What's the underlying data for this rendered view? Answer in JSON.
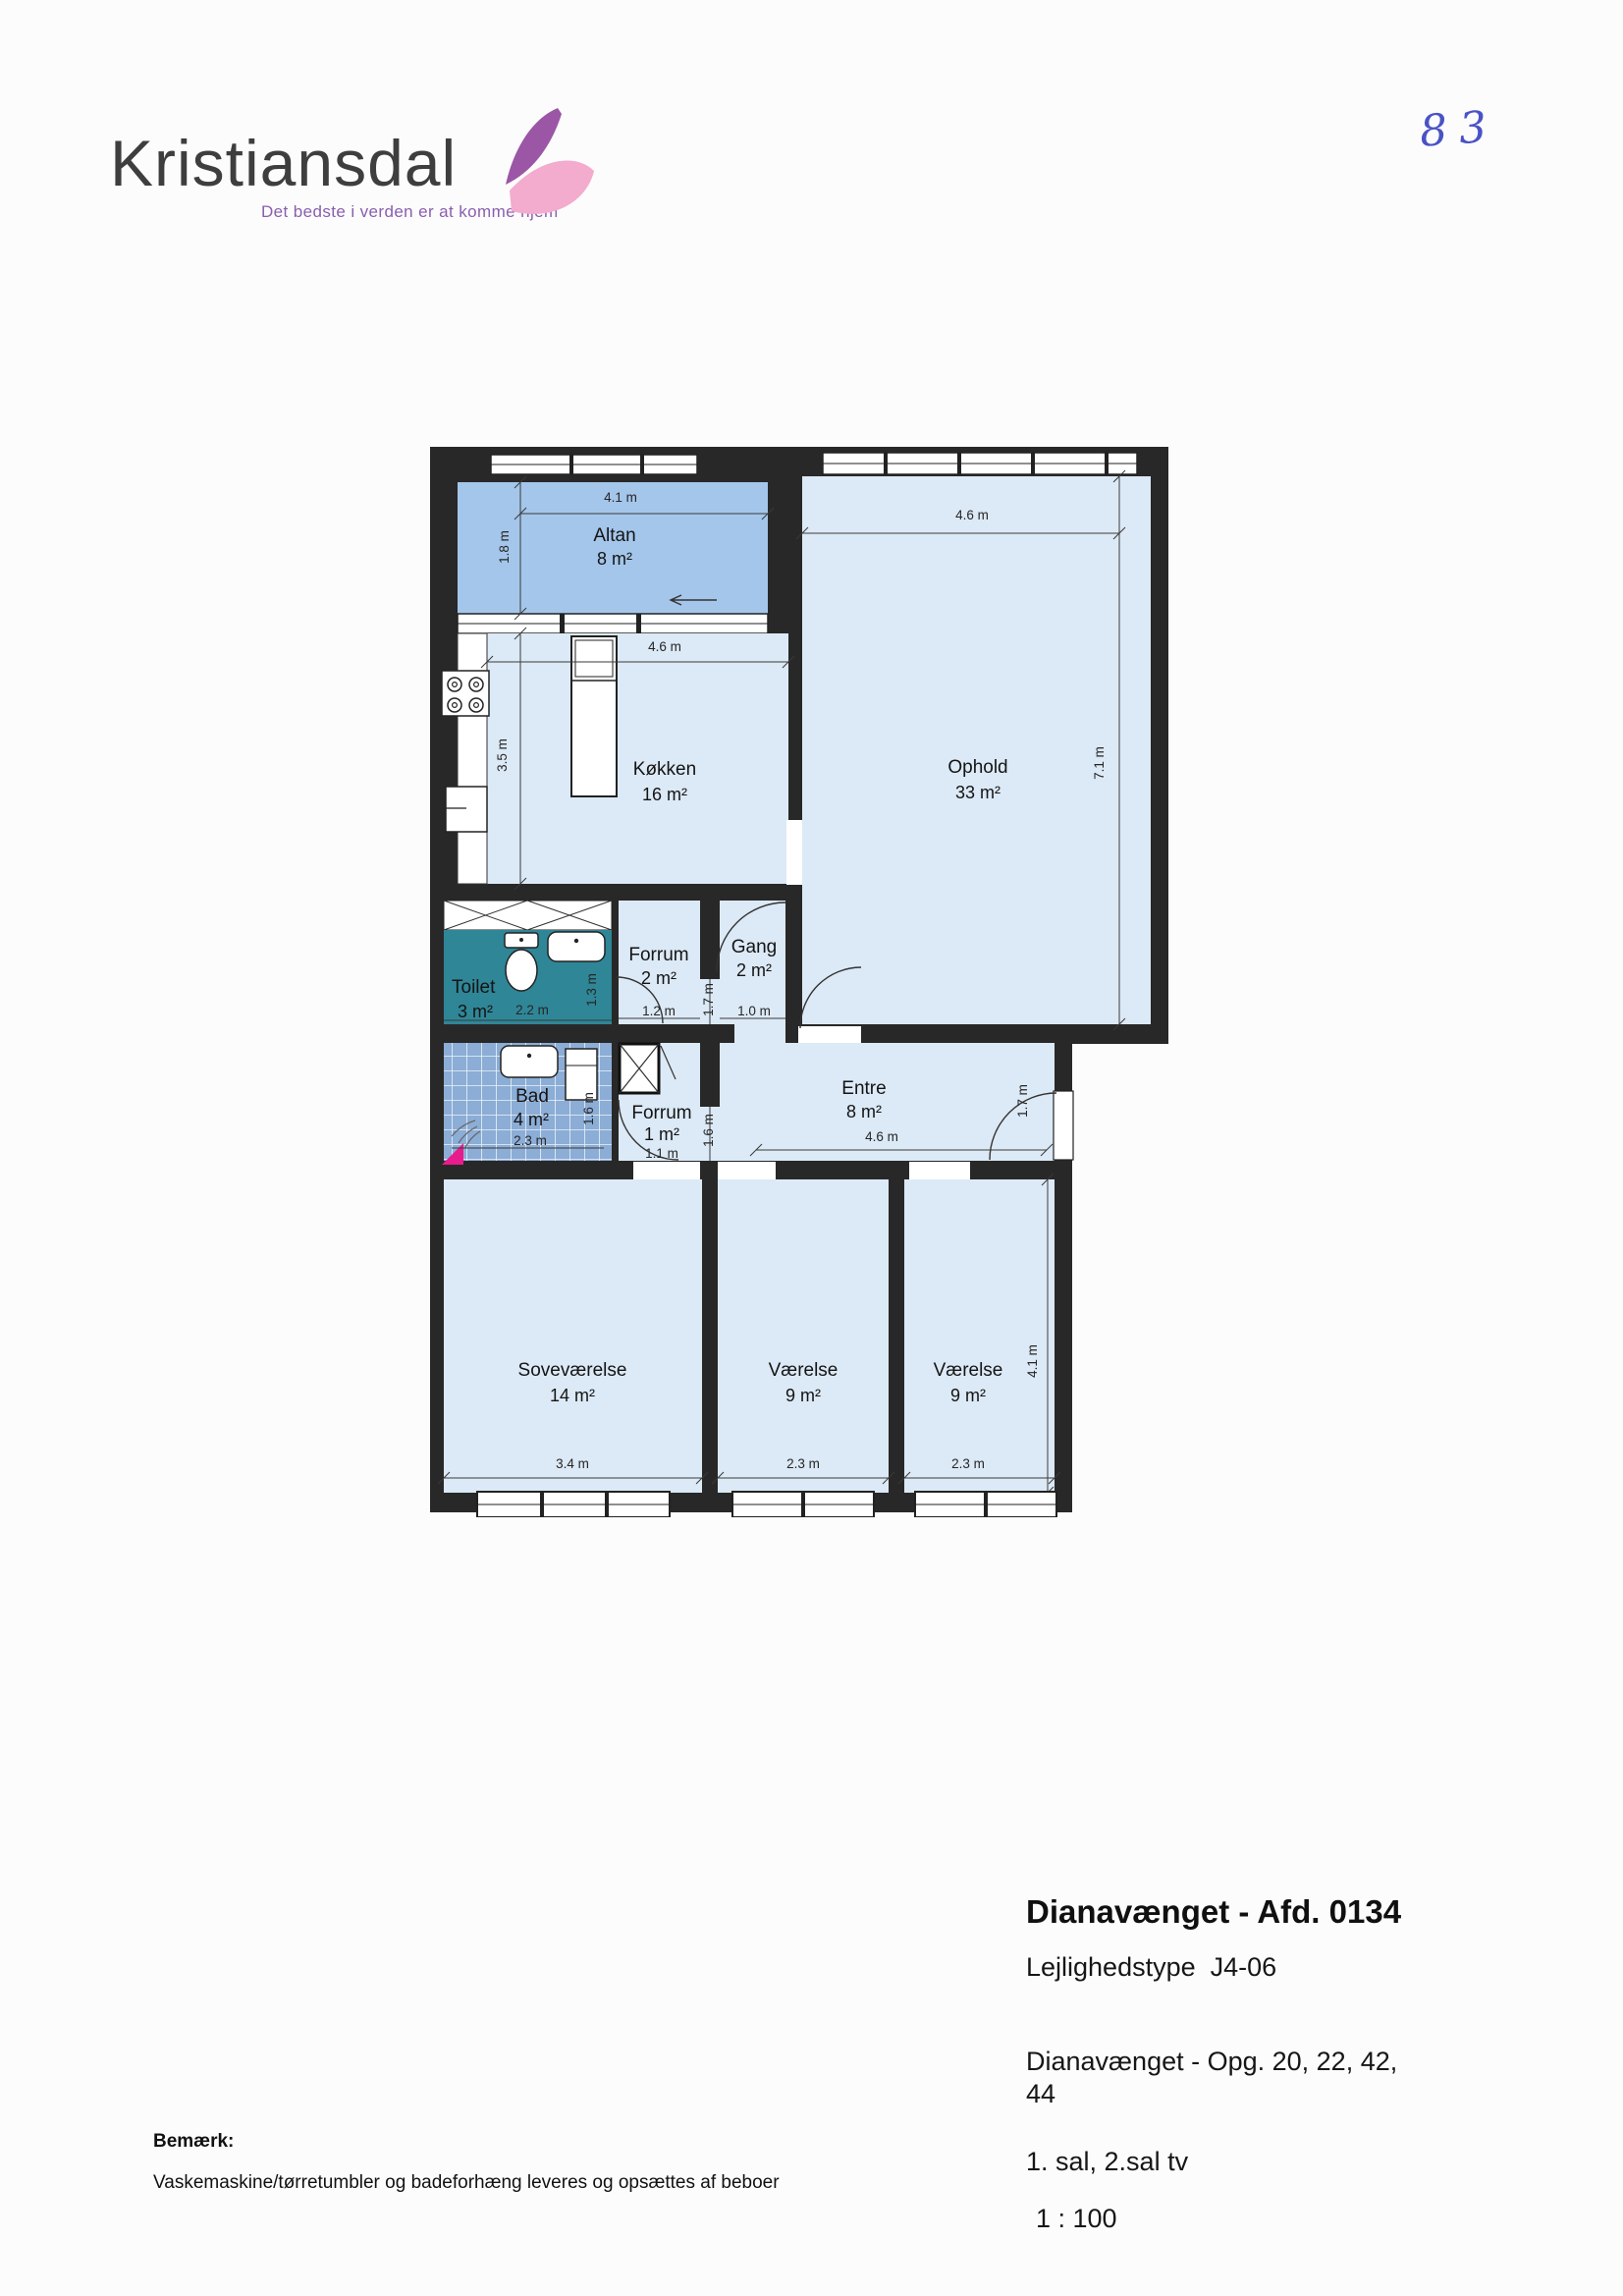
{
  "header": {
    "brand": "Kristiansdal",
    "tagline": "Det bedste i verden er at komme hjem",
    "page_number": "83"
  },
  "plan": {
    "rooms": {
      "altan": {
        "name": "Altan",
        "area": "8 m²",
        "width": "4.1 m",
        "depth": "1.8 m"
      },
      "kokken": {
        "name": "Køkken",
        "area": "16 m²",
        "width": "4.6 m",
        "depth": "3.5 m"
      },
      "ophold": {
        "name": "Ophold",
        "area": "33 m²",
        "width": "4.6 m",
        "depth": "7.1 m"
      },
      "toilet": {
        "name": "Toilet",
        "area": "3 m²",
        "width": "2.2 m",
        "depth": "1.3 m"
      },
      "forrum_2": {
        "name": "Forrum",
        "area": "2 m²",
        "width": "1.2 m",
        "depth": "1.7 m"
      },
      "gang": {
        "name": "Gang",
        "area": "2 m²",
        "width": "1.0 m"
      },
      "bad": {
        "name": "Bad",
        "area": "4 m²",
        "width": "2.3 m",
        "depth": "1.6 m"
      },
      "forrum_1": {
        "name": "Forrum",
        "area": "1 m²",
        "width": "1.1 m",
        "depth": "1.6 m"
      },
      "entre": {
        "name": "Entre",
        "area": "8 m²",
        "width": "4.6 m",
        "depth": "1.7 m"
      },
      "sovevaerelse": {
        "name": "Soveværelse",
        "area": "14 m²",
        "width": "3.4 m"
      },
      "vaerelse_1": {
        "name": "Værelse",
        "area": "9 m²",
        "width": "2.3 m"
      },
      "vaerelse_2": {
        "name": "Værelse",
        "area": "9 m²",
        "width": "2.3 m",
        "depth": "4.1 m"
      }
    }
  },
  "footer": {
    "title": "Dianavænget - Afd. 0134",
    "type_label": "Lejlighedstype  J4-06",
    "address_line1": "Dianavænget - Opg. 20, 22, 42,",
    "address_line2": "44",
    "floor": "1. sal, 2.sal tv",
    "scale": "1 : 100",
    "note_label": "Bemærk:",
    "note": "Vaskemaskine/tørretumbler og badeforhæng leveres og opsættes af beboer"
  },
  "colors": {
    "wall": "#282828",
    "room_fill": "#dce9f6",
    "balcony_fill": "#a4c6ea",
    "toilet_fill": "#2f8697",
    "bath_tile": "#8badd6",
    "shower_pink": "#e81c8c",
    "brand_purple": "#8a5fae",
    "handwriting_blue": "#4a52c6"
  }
}
